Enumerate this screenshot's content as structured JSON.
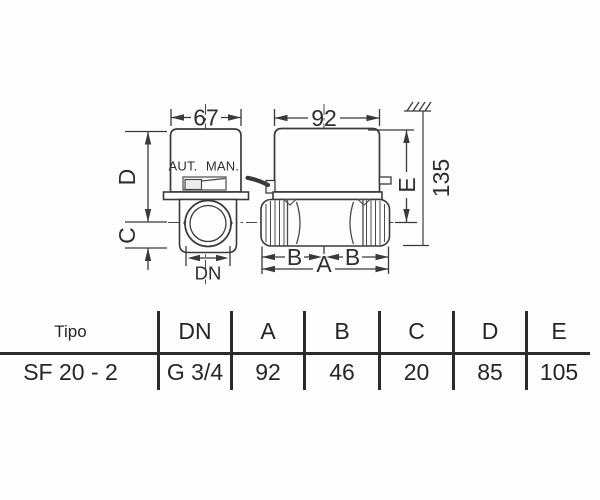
{
  "drawing": {
    "front": {
      "width": "67",
      "aut": "AUT.",
      "man": "MAN.",
      "d": "D",
      "c": "C",
      "dn": "DN"
    },
    "side": {
      "width": "92",
      "e": "E",
      "total": "135",
      "b_left": "B",
      "b_right": "B",
      "a": "A"
    }
  },
  "table": {
    "headers": [
      "Tipo",
      "DN",
      "A",
      "B",
      "C",
      "D",
      "E"
    ],
    "row": [
      "SF 20 - 2",
      "G 3/4",
      "92",
      "46",
      "20",
      "85",
      "105"
    ]
  },
  "colors": {
    "line": "#3a3a3a",
    "text": "#2a2a2a",
    "background": "#fdfdfd"
  }
}
